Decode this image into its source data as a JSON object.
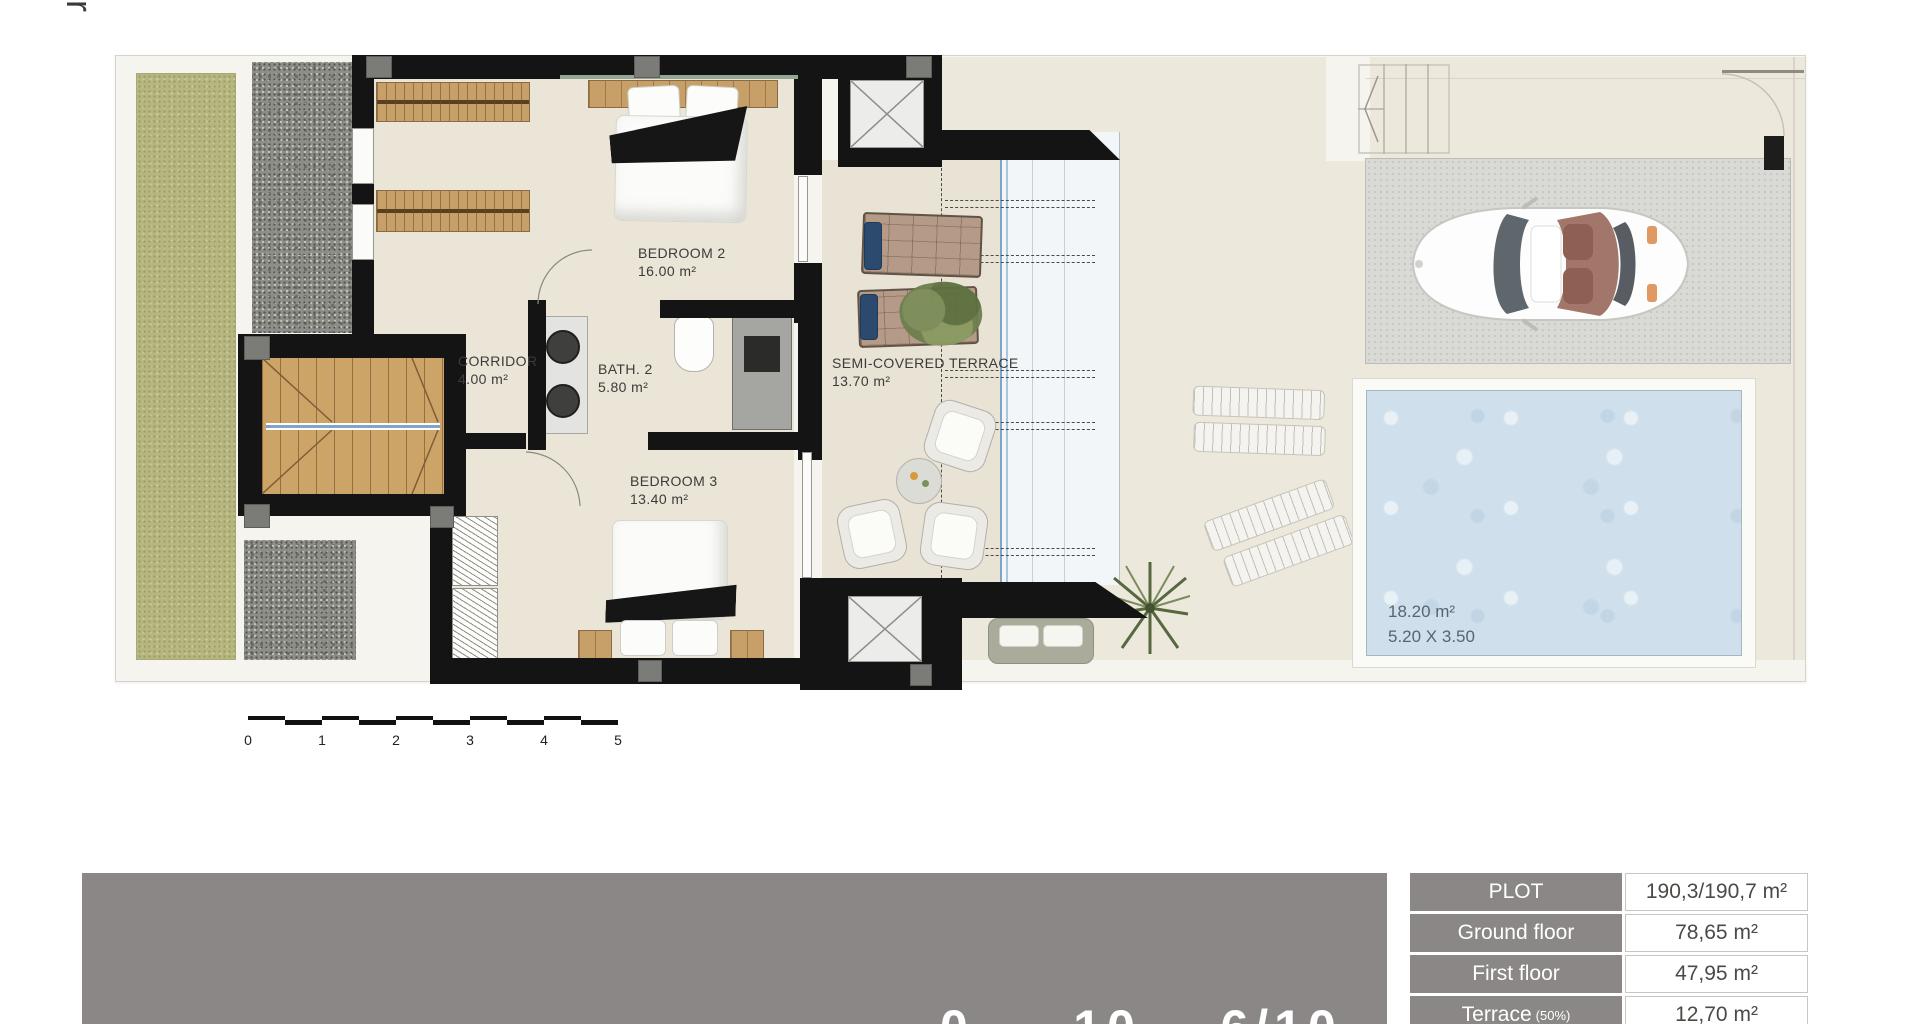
{
  "side_label": "First floor",
  "plan": {
    "rooms": [
      {
        "name": "BEDROOM 2",
        "area": "16.00 m²"
      },
      {
        "name": "CORRIDOR",
        "area": "4.00 m²"
      },
      {
        "name": "BATH. 2",
        "area": "5.80 m²"
      },
      {
        "name": "BEDROOM 3",
        "area": "13.40 m²"
      },
      {
        "name": "SEMI-COVERED TERRACE",
        "area": "13.70 m²"
      }
    ],
    "pool": {
      "area": "18.20 m²",
      "dimensions": "5.20 X 3.50"
    }
  },
  "scale_bar": {
    "ticks": [
      "0",
      "1",
      "2",
      "3",
      "4",
      "5"
    ]
  },
  "footer": {
    "partial_text": "0     10    6/10    0"
  },
  "summary_table": {
    "rows": [
      {
        "label": "PLOT",
        "suffix": "",
        "value": "190,3/190,7 m²"
      },
      {
        "label": "Ground floor",
        "suffix": "",
        "value": "78,65 m²"
      },
      {
        "label": "First floor",
        "suffix": "",
        "value": "47,95 m²"
      },
      {
        "label": "Terrace",
        "suffix": "(50%)",
        "value": "12,70 m²"
      }
    ]
  },
  "colors": {
    "wall": "#141414",
    "table_gray": "#8b8787",
    "pool_water": "#cfe0ec",
    "glass_blue": "#7fa6c8",
    "garden_green": "#b6b680",
    "wood": "#c79f68"
  }
}
